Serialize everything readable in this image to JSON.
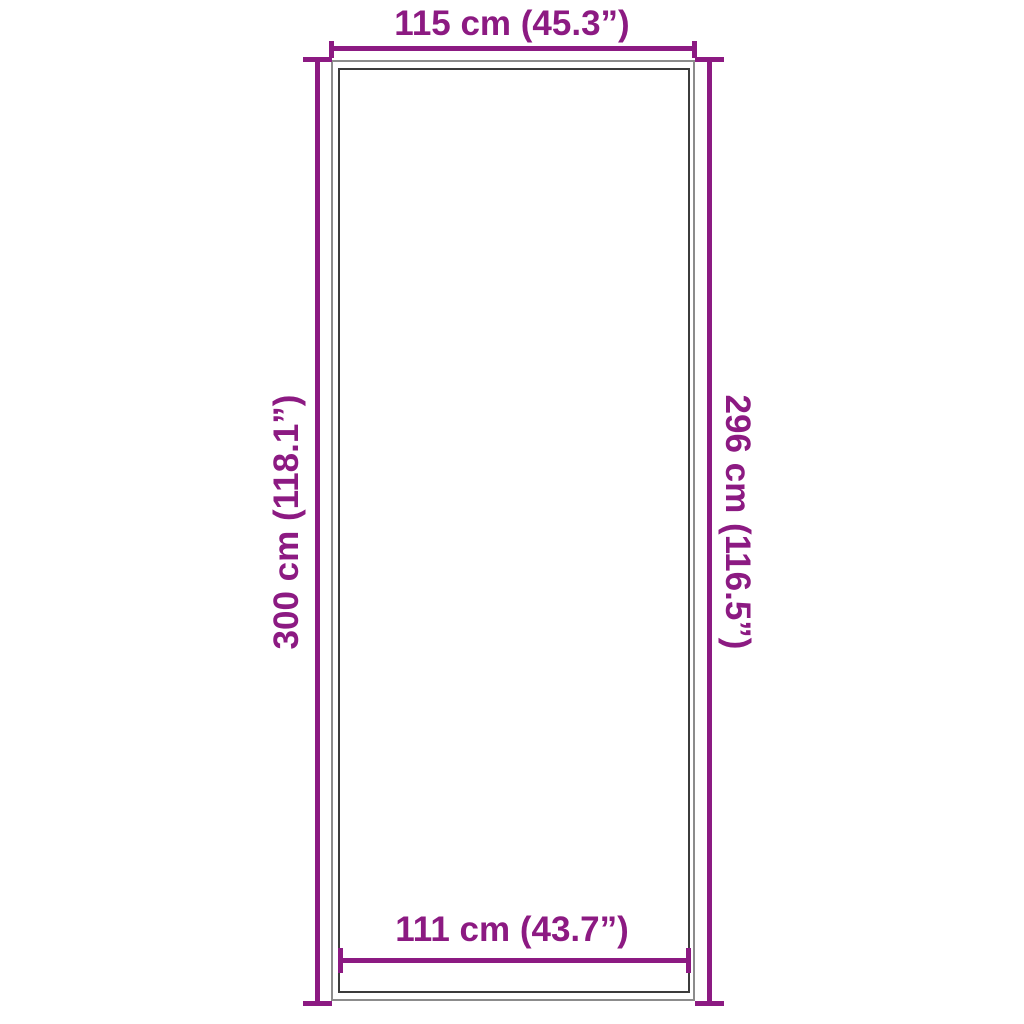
{
  "diagram": {
    "type": "product-dimension-diagram",
    "accent_color": "#8c1a82",
    "outline_outer_color": "#8c8c8c",
    "outline_inner_color": "#3c3c3c",
    "top_dimension": {
      "label": "115 cm (45.3”)"
    },
    "left_dimension": {
      "label": "300 cm (118.1”)"
    },
    "right_dimension": {
      "label": "296 cm (116.5”)"
    },
    "bottom_dimension": {
      "label": "111 cm (43.7”)"
    }
  }
}
